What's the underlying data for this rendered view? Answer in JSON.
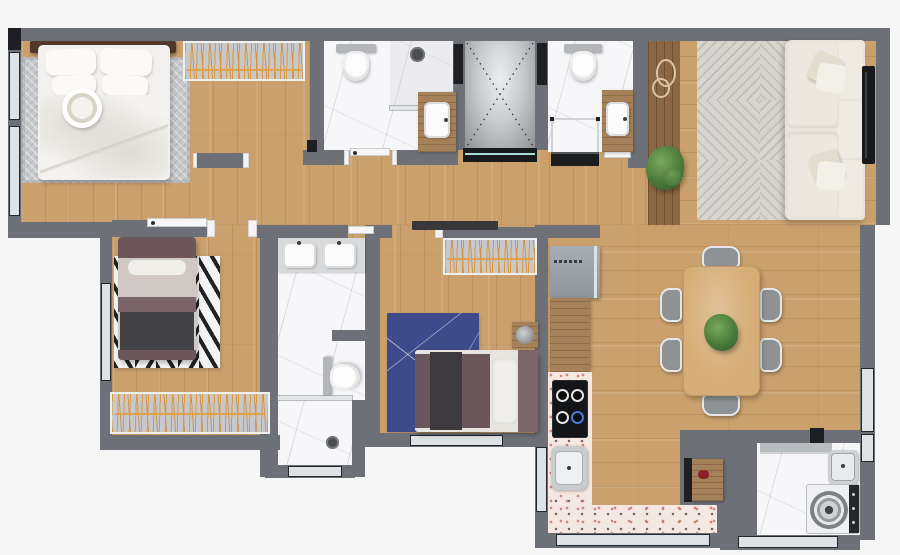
{
  "meta": {
    "title": "apartment-floor-plan",
    "view": "top-down-3d-render",
    "text_labels_visible": "none"
  },
  "palette": {
    "bg": "#f6f6f7",
    "wall": "#6d7076",
    "jambDark": "#1d1f22",
    "glass": "#dfe2e5",
    "frameDark": "#24272a",
    "teal": "#a8dcd6",
    "wood": "#caa06c",
    "deck": "#8b6843",
    "counterWood": "#a5815a",
    "marble": "#f7f7f9",
    "terrazzo": "#f5e7e1",
    "terrDotRed": "rgba(196,118,106,.85)",
    "terrDotDark": "rgba(60,55,52,.75)",
    "rugGray": "#c8c9cb",
    "rugLiving": "#d8d4ce",
    "rugBlue": "#3d4b8a",
    "chevron": "#222225",
    "bedWhite": "#f2f1ef",
    "mauve": "#6b565b",
    "mauveDeep": "#7a646a",
    "throwDark": "#434247",
    "headboard": "#52382a",
    "closetGray": "#c6c8cb",
    "hangerOrange": "#e2952f",
    "appliance": "#9ba1a7",
    "sofa": "#e8e4db",
    "tableWood": "#d5ad76",
    "chair": "#8e9295",
    "plant": "#4a7b38",
    "red": "#8c2026",
    "sinkWhite": "#fbfbfc",
    "elevatorDash": "#3c3f43"
  },
  "rooms": {
    "master_bedroom": {
      "name": "Master Bedroom",
      "items": [
        "double-bed",
        "headboard",
        "gray-area-rug",
        "hanger-wardrobe",
        "decor-bowl"
      ]
    },
    "ensuite_bathroom": {
      "name": "En-suite Bathroom",
      "items": [
        "toilet",
        "walk-in-shower",
        "wood-vanity-sink"
      ]
    },
    "elevator": {
      "name": "Elevator",
      "items": [
        "elevator-cab-x-mark",
        "dark-threshold"
      ]
    },
    "hall_bathroom": {
      "name": "Hall Bathroom",
      "items": [
        "toilet",
        "shower-box",
        "wood-vanity-sink"
      ]
    },
    "bedroom_2": {
      "name": "Bedroom 2",
      "items": [
        "single-bed",
        "chevron-rug",
        "hanger-wardrobe"
      ]
    },
    "shared_bathroom": {
      "name": "Shared Bathroom",
      "items": [
        "double-vanity",
        "toilet",
        "shower-with-drain"
      ]
    },
    "bedroom_3": {
      "name": "Bedroom 3",
      "items": [
        "bed",
        "blue-rug",
        "hanger-wardrobe",
        "side-table",
        "potted-plant"
      ]
    },
    "hallway": {
      "name": "Hallway",
      "items": [
        "doors"
      ]
    },
    "living_room": {
      "name": "Living Room",
      "items": [
        "corner-sofa",
        "patterned-rug",
        "tv-panel",
        "wood-deck-strip",
        "wire-wall-decor",
        "potted-plant"
      ]
    },
    "dining_room": {
      "name": "Dining Room",
      "items": [
        "dining-table",
        "six-chairs",
        "centerpiece-plant"
      ]
    },
    "kitchen": {
      "name": "Kitchen",
      "items": [
        "refrigerator",
        "wood-counter",
        "terrazzo-counter",
        "cooktop-4-burners",
        "kitchen-sink"
      ]
    },
    "laundry": {
      "name": "Laundry / Service",
      "items": [
        "washing-machine",
        "utility-sink",
        "wall-shelf",
        "wood-service-door"
      ]
    }
  },
  "counts": {
    "bedrooms": 3,
    "bathrooms": 3,
    "dining_chairs": 6,
    "cooktop_burners": 4
  }
}
